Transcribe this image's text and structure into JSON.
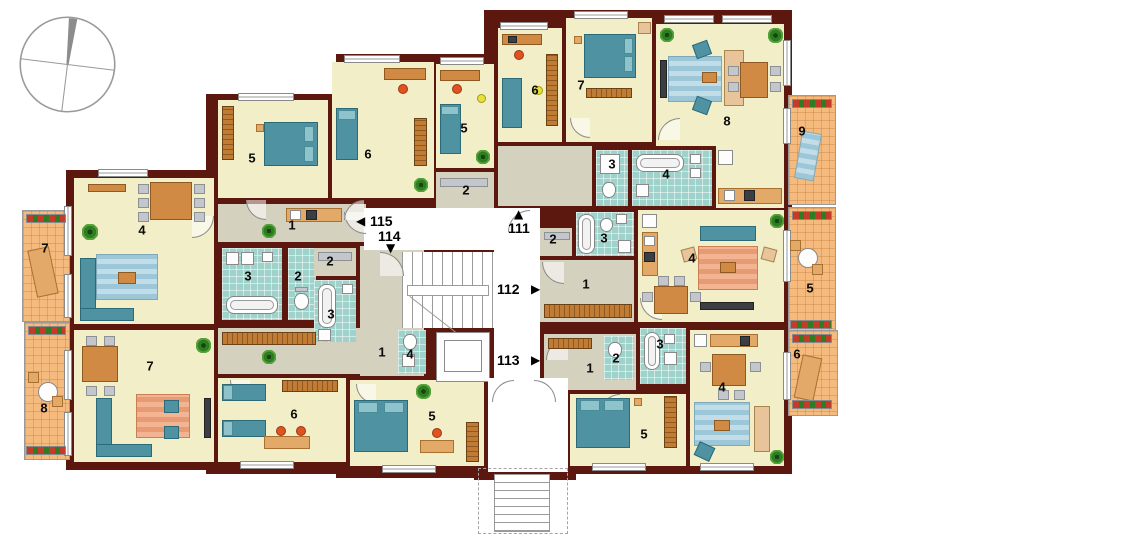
{
  "page": {
    "type": "apartment-floor-plan",
    "background": "#ffffff"
  },
  "compass": {
    "icon": "compass-rose-icon"
  },
  "entrances": [
    {
      "number": "115",
      "arrow": "left",
      "glyph": "◀"
    },
    {
      "number": "114",
      "arrow": "down",
      "glyph": "▼"
    },
    {
      "number": "111",
      "arrow": "up",
      "glyph": "▲"
    },
    {
      "number": "112",
      "arrow": "right",
      "glyph": "▶"
    },
    {
      "number": "113",
      "arrow": "right",
      "glyph": "▶"
    }
  ],
  "rooms": [
    {
      "label": "7",
      "type": "balcony",
      "apartment": "115"
    },
    {
      "label": "8",
      "type": "balcony",
      "apartment": "114"
    },
    {
      "label": "9",
      "type": "balcony",
      "apartment": "111"
    },
    {
      "label": "5",
      "type": "balcony",
      "apartment": "112"
    },
    {
      "label": "6",
      "type": "balcony",
      "apartment": "113"
    },
    {
      "label": "4",
      "type": "living-dining",
      "apartment": "115"
    },
    {
      "label": "5",
      "type": "bedroom",
      "apartment": "115"
    },
    {
      "label": "6",
      "type": "kids-room",
      "apartment": "115"
    },
    {
      "label": "1",
      "type": "hallway",
      "apartment": "115"
    },
    {
      "label": "3",
      "type": "bathroom",
      "apartment": "115"
    },
    {
      "label": "2",
      "type": "wc",
      "apartment": "115"
    },
    {
      "label": "7",
      "type": "living-room",
      "apartment": "114"
    },
    {
      "label": "1",
      "type": "hallway",
      "apartment": "114"
    },
    {
      "label": "2",
      "type": "storage",
      "apartment": "114"
    },
    {
      "label": "3",
      "type": "bathroom",
      "apartment": "114"
    },
    {
      "label": "4",
      "type": "wc",
      "apartment": "114"
    },
    {
      "label": "6",
      "type": "kids-room",
      "apartment": "114"
    },
    {
      "label": "5",
      "type": "kids-room",
      "apartment": "114"
    },
    {
      "label": "5",
      "type": "kids-room",
      "apartment": "111"
    },
    {
      "label": "2",
      "type": "storage",
      "apartment": "111"
    },
    {
      "label": "6",
      "type": "office",
      "apartment": "111"
    },
    {
      "label": "7",
      "type": "bedroom",
      "apartment": "111"
    },
    {
      "label": "8",
      "type": "living-room",
      "apartment": "111"
    },
    {
      "label": "3",
      "type": "wc",
      "apartment": "111"
    },
    {
      "label": "4",
      "type": "bathroom",
      "apartment": "111"
    },
    {
      "label": "2",
      "type": "storage",
      "apartment": "112"
    },
    {
      "label": "3",
      "type": "bathroom",
      "apartment": "112"
    },
    {
      "label": "1",
      "type": "hallway",
      "apartment": "112"
    },
    {
      "label": "4",
      "type": "living-room",
      "apartment": "112"
    },
    {
      "label": "1",
      "type": "hallway",
      "apartment": "113"
    },
    {
      "label": "2",
      "type": "wc",
      "apartment": "113"
    },
    {
      "label": "3",
      "type": "bathroom",
      "apartment": "113"
    },
    {
      "label": "4",
      "type": "living-room",
      "apartment": "113"
    },
    {
      "label": "5",
      "type": "bedroom",
      "apartment": "113"
    }
  ],
  "colors": {
    "wall": "#5c180f",
    "room_floor": "#f2efc8",
    "hallway_floor": "#d5d1bf",
    "bathroom_tile": "#9ed2cb",
    "balcony_tile": "#f5ba7e",
    "furniture_teal": "#4f93a3",
    "furniture_wood": "#d08a44"
  }
}
